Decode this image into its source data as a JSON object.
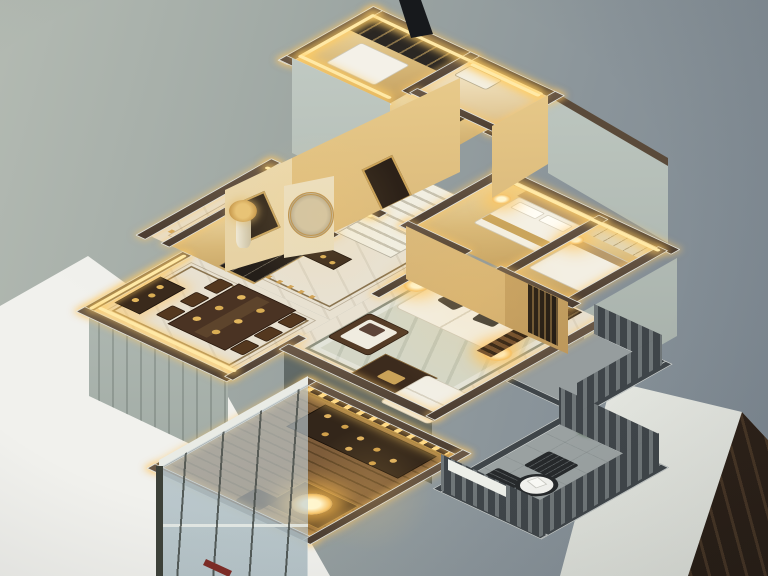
{
  "meta": {
    "description": "Photograph of a miniature architectural scale model of an apartment interior, viewed from above at an angle",
    "lighting": "warm LED strips along every wall top, glowing miniature lamps",
    "setting": "model standing on a white table against a gray studio wall"
  },
  "palette": {
    "backdrop-1": "#b3bab2",
    "backdrop-2": "#7b8690",
    "table-white-1": "#f1f1ed",
    "table-white-2": "#d6d9d2",
    "sage-1": "#c5cec7",
    "sage-2": "#98a29c",
    "cap-brown-1": "#6b5947",
    "cap-brown-2": "#4b3d31",
    "cap-trim": "#eef0ea",
    "led": "#ffe9a6",
    "glow": "rgba(255,205,100,0.9)",
    "gold-wall-1": "#f0d494",
    "gold-wall-2": "#bb9255",
    "marble": "#e8e1d1",
    "marble-rug": "#d4d6c6",
    "inlay": "#8a7450",
    "wood-floor-1": "#7d5c3a",
    "wood-floor-2": "#5e4527",
    "dark-wood": "#3a2a1c",
    "sofa-white": "#f2efe5",
    "glass-1": "rgba(218,228,231,0.5)",
    "glass-2": "rgba(168,184,190,0.35)",
    "rail": "#3f4549",
    "balcony-floor": "#9aa1a1",
    "lamp-core": "#fff6cf",
    "lamp-mid": "#f6c369",
    "plant-green": "#4e7b3a",
    "pencil-red": "#7e2c26"
  },
  "scene": {
    "rooms": [
      {
        "name": "upper-bedroom",
        "features": [
          "dark glass partition",
          "white bed",
          "LED rim"
        ]
      },
      {
        "name": "upper-bathroom",
        "features": [
          "bright marble floor"
        ]
      },
      {
        "name": "stair-landing",
        "features": [
          "white staircase",
          "framed picture on gold wall"
        ]
      },
      {
        "name": "foyer",
        "features": [
          "marble floor with dark inlay",
          "console table",
          "moon-gate panel",
          "artwork",
          "tall vase",
          "gold dotted floor line"
        ]
      },
      {
        "name": "kitchen",
        "features": [
          "dark framed glass sliding doors"
        ]
      },
      {
        "name": "dining-room",
        "features": [
          "dark wood table",
          "six chairs",
          "gold place settings",
          "lit sideboard niche"
        ]
      },
      {
        "name": "living-room",
        "features": [
          "white panel TV wall",
          "white sofa with dark pillows",
          "armchair",
          "chaise",
          "coffee table",
          "two glowing lamps",
          "wood slat screen with lantern"
        ]
      },
      {
        "name": "bedroom-1",
        "features": [
          "bed with headboard",
          "wardrobe",
          "bedside lamp"
        ]
      },
      {
        "name": "bedroom-2",
        "features": [
          "cream wardrobe",
          "bed"
        ]
      },
      {
        "name": "study",
        "features": [
          "wood plank floor",
          "glass curtain walls",
          "display cabinet",
          "desk",
          "bright pendant lamp",
          "LED dot beam"
        ]
      },
      {
        "name": "balcony",
        "features": [
          "slat railing",
          "two dark chairs",
          "round white table",
          "potted plant"
        ]
      },
      {
        "name": "side-balcony",
        "features": [
          "slat railing"
        ]
      }
    ],
    "foreground": [
      "white table surface",
      "dark wood floor corner",
      "red pencil",
      "black tripod pole"
    ]
  }
}
